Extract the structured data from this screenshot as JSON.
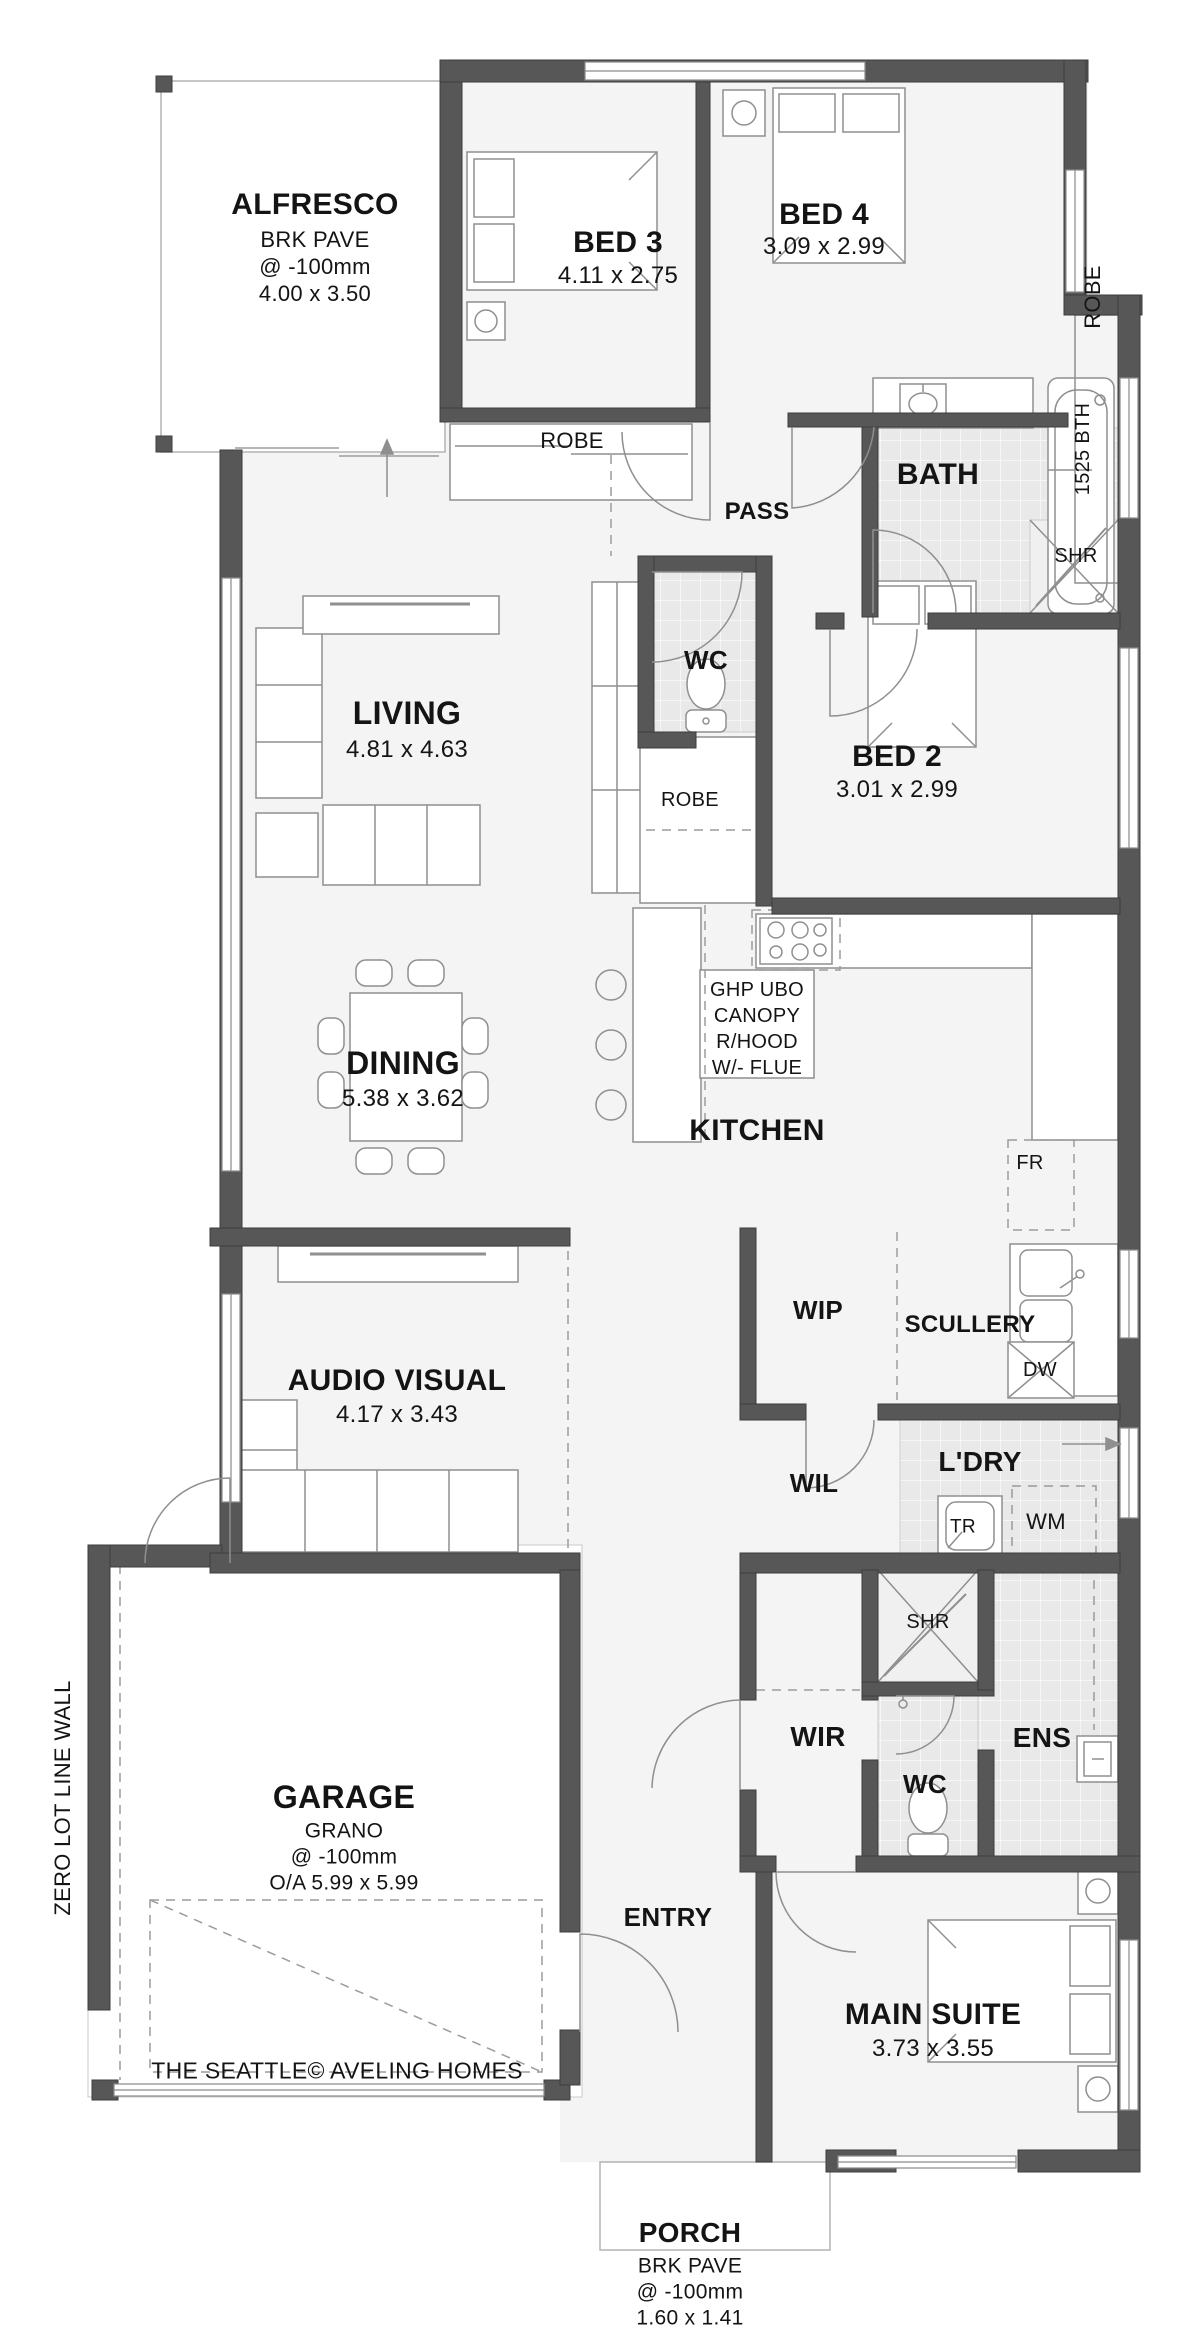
{
  "document": {
    "footer": "THE SEATTLE© AVELING HOMES",
    "side_note": "ZERO LOT LINE WALL"
  },
  "colors": {
    "wall": "#575757",
    "wall_edge": "#3d3d3d",
    "thin_line": "#999999",
    "tile": "#e9e9e9",
    "room_fill": "#f4f4f4",
    "text": "#141414",
    "background": "#ffffff"
  },
  "rooms": [
    {
      "name": "ALFRESCO",
      "finish": "BRK PAVE",
      "level": "@ -100mm",
      "dims": "4.00 x 3.50"
    },
    {
      "name": "BED 3",
      "dims": "4.11 x 2.75"
    },
    {
      "name": "BED 4",
      "dims": "3.09 x 2.99"
    },
    {
      "name": "BATH",
      "fixtures": [
        "1525 BTH",
        "SHR"
      ]
    },
    {
      "name": "PASS"
    },
    {
      "name": "WC"
    },
    {
      "name": "BED 2",
      "dims": "3.01 x 2.99",
      "storage": "ROBE"
    },
    {
      "name": "LIVING",
      "dims": "4.81 x 4.63"
    },
    {
      "name": "DINING",
      "dims": "5.38 x 3.62"
    },
    {
      "name": "KITCHEN",
      "notes": [
        "GHP UBO",
        "CANOPY",
        "R/HOOD",
        "W/- FLUE"
      ],
      "fixtures": [
        "FR"
      ]
    },
    {
      "name": "WIP"
    },
    {
      "name": "SCULLERY",
      "fixtures": [
        "DW"
      ]
    },
    {
      "name": "AUDIO VISUAL",
      "dims": "4.17 x 3.43"
    },
    {
      "name": "WIL"
    },
    {
      "name": "L'DRY",
      "fixtures": [
        "TR",
        "WM"
      ]
    },
    {
      "name": "WIR"
    },
    {
      "name": "ENS",
      "fixtures": [
        "SHR",
        "WC"
      ]
    },
    {
      "name": "ENTRY"
    },
    {
      "name": "GARAGE",
      "finish": "GRANO",
      "level": "@ -100mm",
      "dims": "O/A  5.99 x 5.99"
    },
    {
      "name": "MAIN SUITE",
      "dims": "3.73 x 3.55"
    },
    {
      "name": "PORCH",
      "finish": "BRK PAVE",
      "level": "@ -100mm",
      "dims": "1.60 x 1.41"
    }
  ],
  "labels": [
    {
      "id": "alfresco-name",
      "text": "ALFRESCO",
      "x": 315,
      "y": 205,
      "size": 30,
      "bold": true
    },
    {
      "id": "alfresco-finish",
      "text": "BRK PAVE",
      "x": 315,
      "y": 240,
      "size": 22,
      "bold": false
    },
    {
      "id": "alfresco-level",
      "text": "@ -100mm",
      "x": 315,
      "y": 267,
      "size": 22,
      "bold": false
    },
    {
      "id": "alfresco-dims",
      "text": "4.00 x 3.50",
      "x": 315,
      "y": 294,
      "size": 22,
      "bold": false
    },
    {
      "id": "bed3-name",
      "text": "BED 3",
      "x": 618,
      "y": 243,
      "size": 30,
      "bold": true
    },
    {
      "id": "bed3-dims",
      "text": "4.11 x 2.75",
      "x": 618,
      "y": 276,
      "size": 24,
      "bold": false
    },
    {
      "id": "bed4-name",
      "text": "BED 4",
      "x": 824,
      "y": 215,
      "size": 30,
      "bold": true
    },
    {
      "id": "bed4-dims",
      "text": "3.09 x 2.99",
      "x": 824,
      "y": 247,
      "size": 24,
      "bold": false
    },
    {
      "id": "robe-bed4",
      "text": "ROBE",
      "x": 1093,
      "y": 297,
      "size": 22,
      "bold": false,
      "rotate": true
    },
    {
      "id": "robe-bed3",
      "text": "ROBE",
      "x": 572,
      "y": 441,
      "size": 22,
      "bold": false
    },
    {
      "id": "pass",
      "text": "PASS",
      "x": 757,
      "y": 512,
      "size": 24,
      "bold": true
    },
    {
      "id": "bath-name",
      "text": "BATH",
      "x": 938,
      "y": 475,
      "size": 30,
      "bold": true
    },
    {
      "id": "bath-tub",
      "text": "1525 BTH",
      "x": 1083,
      "y": 449,
      "size": 20,
      "bold": false,
      "rotate": true
    },
    {
      "id": "shr-bath",
      "text": "SHR",
      "x": 1076,
      "y": 556,
      "size": 20,
      "bold": false
    },
    {
      "id": "wc-main",
      "text": "WC",
      "x": 706,
      "y": 660,
      "size": 26,
      "bold": true
    },
    {
      "id": "robe-bed2",
      "text": "ROBE",
      "x": 690,
      "y": 800,
      "size": 20,
      "bold": false
    },
    {
      "id": "bed2-name",
      "text": "BED 2",
      "x": 897,
      "y": 757,
      "size": 30,
      "bold": true
    },
    {
      "id": "bed2-dims",
      "text": "3.01 x 2.99",
      "x": 897,
      "y": 790,
      "size": 24,
      "bold": false
    },
    {
      "id": "living-name",
      "text": "LIVING",
      "x": 407,
      "y": 713,
      "size": 32,
      "bold": true
    },
    {
      "id": "living-dims",
      "text": "4.81 x 4.63",
      "x": 407,
      "y": 750,
      "size": 24,
      "bold": false
    },
    {
      "id": "dining-name",
      "text": "DINING",
      "x": 403,
      "y": 1063,
      "size": 32,
      "bold": true
    },
    {
      "id": "dining-dims",
      "text": "5.38 x 3.62",
      "x": 403,
      "y": 1099,
      "size": 24,
      "bold": false
    },
    {
      "id": "kitchen-note1",
      "text": "GHP UBO",
      "x": 757,
      "y": 990,
      "size": 20,
      "bold": false
    },
    {
      "id": "kitchen-note2",
      "text": "CANOPY",
      "x": 757,
      "y": 1016,
      "size": 20,
      "bold": false
    },
    {
      "id": "kitchen-note3",
      "text": "R/HOOD",
      "x": 757,
      "y": 1042,
      "size": 20,
      "bold": false
    },
    {
      "id": "kitchen-note4",
      "text": "W/- FLUE",
      "x": 757,
      "y": 1068,
      "size": 20,
      "bold": false
    },
    {
      "id": "kitchen-name",
      "text": "KITCHEN",
      "x": 757,
      "y": 1131,
      "size": 30,
      "bold": true
    },
    {
      "id": "fr",
      "text": "FR",
      "x": 1030,
      "y": 1163,
      "size": 20,
      "bold": false
    },
    {
      "id": "wip",
      "text": "WIP",
      "x": 818,
      "y": 1310,
      "size": 26,
      "bold": true
    },
    {
      "id": "scullery",
      "text": "SCULLERY",
      "x": 970,
      "y": 1325,
      "size": 24,
      "bold": true
    },
    {
      "id": "dw",
      "text": "DW",
      "x": 1040,
      "y": 1370,
      "size": 20,
      "bold": false
    },
    {
      "id": "av-name",
      "text": "AUDIO VISUAL",
      "x": 397,
      "y": 1381,
      "size": 30,
      "bold": true
    },
    {
      "id": "av-dims",
      "text": "4.17 x 3.43",
      "x": 397,
      "y": 1415,
      "size": 24,
      "bold": false
    },
    {
      "id": "wil",
      "text": "WIL",
      "x": 814,
      "y": 1483,
      "size": 26,
      "bold": true
    },
    {
      "id": "ldry",
      "text": "L'DRY",
      "x": 980,
      "y": 1462,
      "size": 28,
      "bold": true
    },
    {
      "id": "tr",
      "text": "TR",
      "x": 963,
      "y": 1527,
      "size": 19,
      "bold": false
    },
    {
      "id": "wm",
      "text": "WM",
      "x": 1046,
      "y": 1522,
      "size": 22,
      "bold": false
    },
    {
      "id": "shr-ens",
      "text": "SHR",
      "x": 928,
      "y": 1622,
      "size": 20,
      "bold": false
    },
    {
      "id": "wir",
      "text": "WIR",
      "x": 818,
      "y": 1737,
      "size": 28,
      "bold": true
    },
    {
      "id": "wc-ens",
      "text": "WC",
      "x": 925,
      "y": 1784,
      "size": 26,
      "bold": true
    },
    {
      "id": "ens",
      "text": "ENS",
      "x": 1042,
      "y": 1738,
      "size": 28,
      "bold": true
    },
    {
      "id": "entry",
      "text": "ENTRY",
      "x": 668,
      "y": 1917,
      "size": 26,
      "bold": true
    },
    {
      "id": "garage-name",
      "text": "GARAGE",
      "x": 344,
      "y": 1797,
      "size": 32,
      "bold": true
    },
    {
      "id": "garage-finish",
      "text": "GRANO",
      "x": 344,
      "y": 1831,
      "size": 21,
      "bold": false
    },
    {
      "id": "garage-level",
      "text": "@ -100mm",
      "x": 344,
      "y": 1857,
      "size": 21,
      "bold": false
    },
    {
      "id": "garage-oa",
      "text": "O/A  5.99 x 5.99",
      "x": 344,
      "y": 1883,
      "size": 21,
      "bold": false
    },
    {
      "id": "footer",
      "text": "THE SEATTLE© AVELING HOMES",
      "x": 337,
      "y": 2071,
      "size": 23,
      "bold": false
    },
    {
      "id": "suite-name",
      "text": "MAIN SUITE",
      "x": 933,
      "y": 2015,
      "size": 30,
      "bold": true
    },
    {
      "id": "suite-dims",
      "text": "3.73 x 3.55",
      "x": 933,
      "y": 2049,
      "size": 24,
      "bold": false
    },
    {
      "id": "porch-name",
      "text": "PORCH",
      "x": 690,
      "y": 2233,
      "size": 28,
      "bold": true
    },
    {
      "id": "porch-finish",
      "text": "BRK PAVE",
      "x": 690,
      "y": 2266,
      "size": 21,
      "bold": false
    },
    {
      "id": "porch-level",
      "text": "@ -100mm",
      "x": 690,
      "y": 2292,
      "size": 21,
      "bold": false
    },
    {
      "id": "porch-dims",
      "text": "1.60 x 1.41",
      "x": 690,
      "y": 2318,
      "size": 21,
      "bold": false
    },
    {
      "id": "zero-lot-line",
      "text": "ZERO LOT LINE WALL",
      "x": 63,
      "y": 1798,
      "size": 22,
      "bold": false,
      "rotate": true
    }
  ]
}
